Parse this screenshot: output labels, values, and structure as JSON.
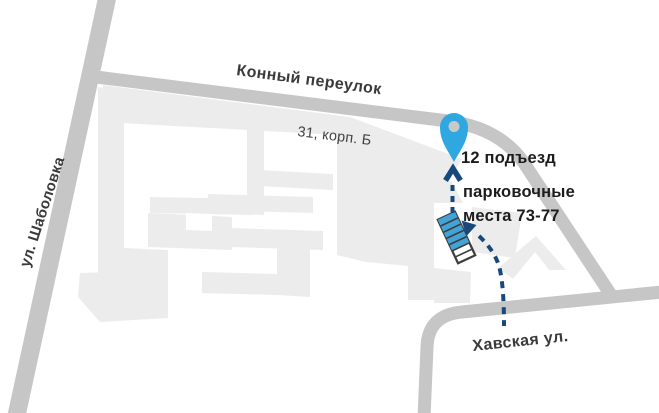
{
  "map": {
    "streets": {
      "top": "Конный переулок",
      "left": "ул. Шаболовка",
      "bottom": "Хавская ул."
    },
    "building_label": "31, корп. Б",
    "annotations": {
      "entrance": "12 подъезд",
      "parking_line1": "парковочные",
      "parking_line2": "места 73-77"
    },
    "colors": {
      "background": "#ffffff",
      "road": "#c6c6c6",
      "building": "#ececec",
      "white": "#ffffff",
      "pin": "#2fa7e0",
      "pin_hole": "#c9c9c9",
      "route": "#19497b",
      "parking_fill": "#44a3d6",
      "parking_stroke": "#3d3d3d",
      "street_label": "#3a3a3a",
      "building_label": "#424242",
      "annotation_label": "#1c1c1c"
    }
  }
}
